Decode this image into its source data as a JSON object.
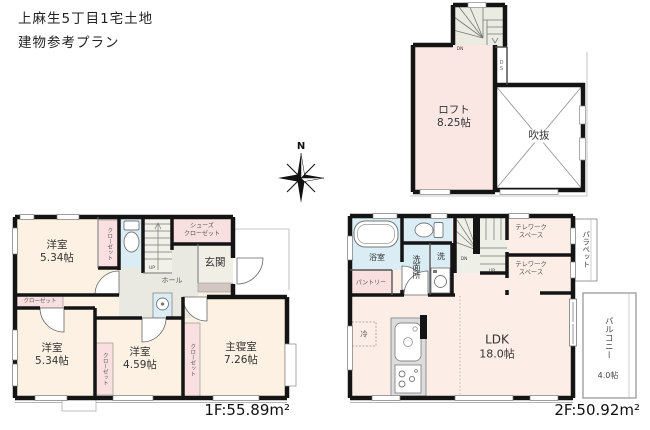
{
  "page": {
    "title_line1": "上麻生5丁目1宅土地",
    "title_line2": "建物参考プラン"
  },
  "compass": {
    "north": "N"
  },
  "loft_plan": {
    "loft_name": "ロフト",
    "loft_size": "8.25帖",
    "void_label": "吹抜",
    "duct_label": "DS",
    "down_label": "DN"
  },
  "floor1": {
    "area_label": "1F:55.89m²",
    "bedroom_nw_name": "洋室",
    "bedroom_nw_size": "5.34帖",
    "closet_nw": "クローゼット",
    "shoes_line1": "シューズ",
    "shoes_line2": "クローゼット",
    "entrance": "玄関",
    "hall": "ホール",
    "up_label": "UP",
    "closet_w": "クローゼット",
    "bedroom_sw_name": "洋室",
    "bedroom_sw_size": "5.34帖",
    "bedroom_s_name": "洋室",
    "bedroom_s_size": "4.59帖",
    "closet_s": "クローゼット",
    "closet_master": "クローゼット",
    "master_name": "主寝室",
    "master_size": "7.26帖"
  },
  "floor2": {
    "area_label": "2F:50.92m²",
    "bath": "浴室",
    "washroom": "洗面所",
    "laundry": "洗",
    "pantry": "パントリー",
    "telework1_line1": "テレワーク",
    "telework1_line2": "スペース",
    "telework2_line1": "テレワーク",
    "telework2_line2": "スペース",
    "parapet": "パラペット",
    "down_label": "DN",
    "up_label": "UP",
    "ldk_name": "LDK",
    "ldk_size": "18.0帖",
    "fridge": "冷",
    "balcony_name": "バルコニー",
    "balcony_size": "4.0帖"
  }
}
